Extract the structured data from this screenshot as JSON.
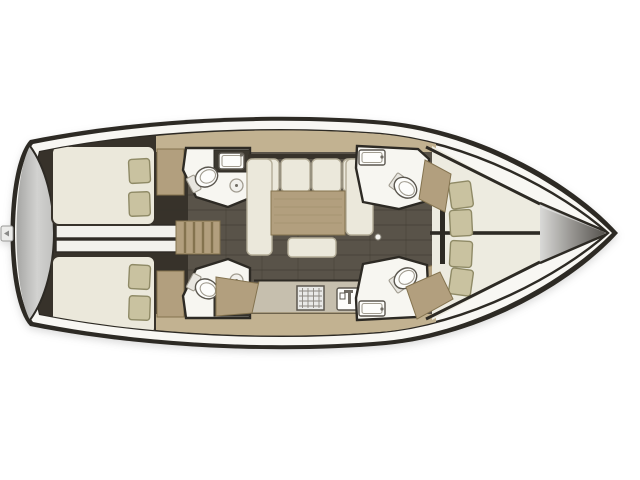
{
  "meta": {
    "title": "Sailing yacht interior layout floor plan, top view, bow pointing right",
    "type": "boat-floorplan",
    "orientation": "bow-right-stern-left"
  },
  "colors": {
    "page_bg": "#ffffff",
    "hull_outline": "#2d2a24",
    "deck": "#f8f7f3",
    "aft_dark": "#37322a",
    "salon_floor": "#595349",
    "plank_line": "#353028",
    "wood": "#b29f7e",
    "wood_light": "#c2b291",
    "wood_dark": "#84734f",
    "wood_grain": "#a3916f",
    "counter": "#c6bfae",
    "counter_dark": "#3c3830",
    "upholstery": "#ebe8db",
    "upholstery_line": "#b4ad98",
    "pillow": "#c9c2a0",
    "pillow_line": "#8f8a66",
    "bathroom": "#f7f6f1",
    "fixture_white": "#fdfdfb",
    "fixture_line": "#5b574f",
    "fixture_soft": "#a19c90",
    "metal": "#6f6b63",
    "white_strip": "#f2f1ec",
    "berth_cream": "#edebe0"
  },
  "gradients": {
    "transom": [
      "#a6a6a4",
      "#d2d2d0",
      "#c0c0be"
    ],
    "bow_cone": [
      "#d9d9d7",
      "#8e8c88",
      "#55524d"
    ]
  },
  "areas": [
    {
      "id": "swim-platform",
      "label": "stern swim platform"
    },
    {
      "id": "aft-cabin-port",
      "label": "aft double cabin, 2 pillows"
    },
    {
      "id": "aft-cabin-starboard",
      "label": "aft double cabin, 2 pillows"
    },
    {
      "id": "quarter-berth-access",
      "label": "central aft compartment"
    },
    {
      "id": "companionway-steps",
      "label": "companionway wooden steps"
    },
    {
      "id": "aft-head-port",
      "label": "aft bathroom: toilet, basin, counter"
    },
    {
      "id": "aft-head-starboard",
      "label": "aft bathroom: toilet, basin, counter"
    },
    {
      "id": "saloon",
      "label": "saloon with U-sofa, table and ottoman"
    },
    {
      "id": "galley",
      "label": "galley with stove and sink"
    },
    {
      "id": "forward-head-port",
      "label": "forward bathroom: toilet and basin"
    },
    {
      "id": "forward-head-starboard",
      "label": "forward bathroom: toilet and basin"
    },
    {
      "id": "forward-cabin-vberth",
      "label": "forward V-berth cabin, 4 pillows"
    },
    {
      "id": "bow-locker",
      "label": "bow anchor locker"
    }
  ]
}
